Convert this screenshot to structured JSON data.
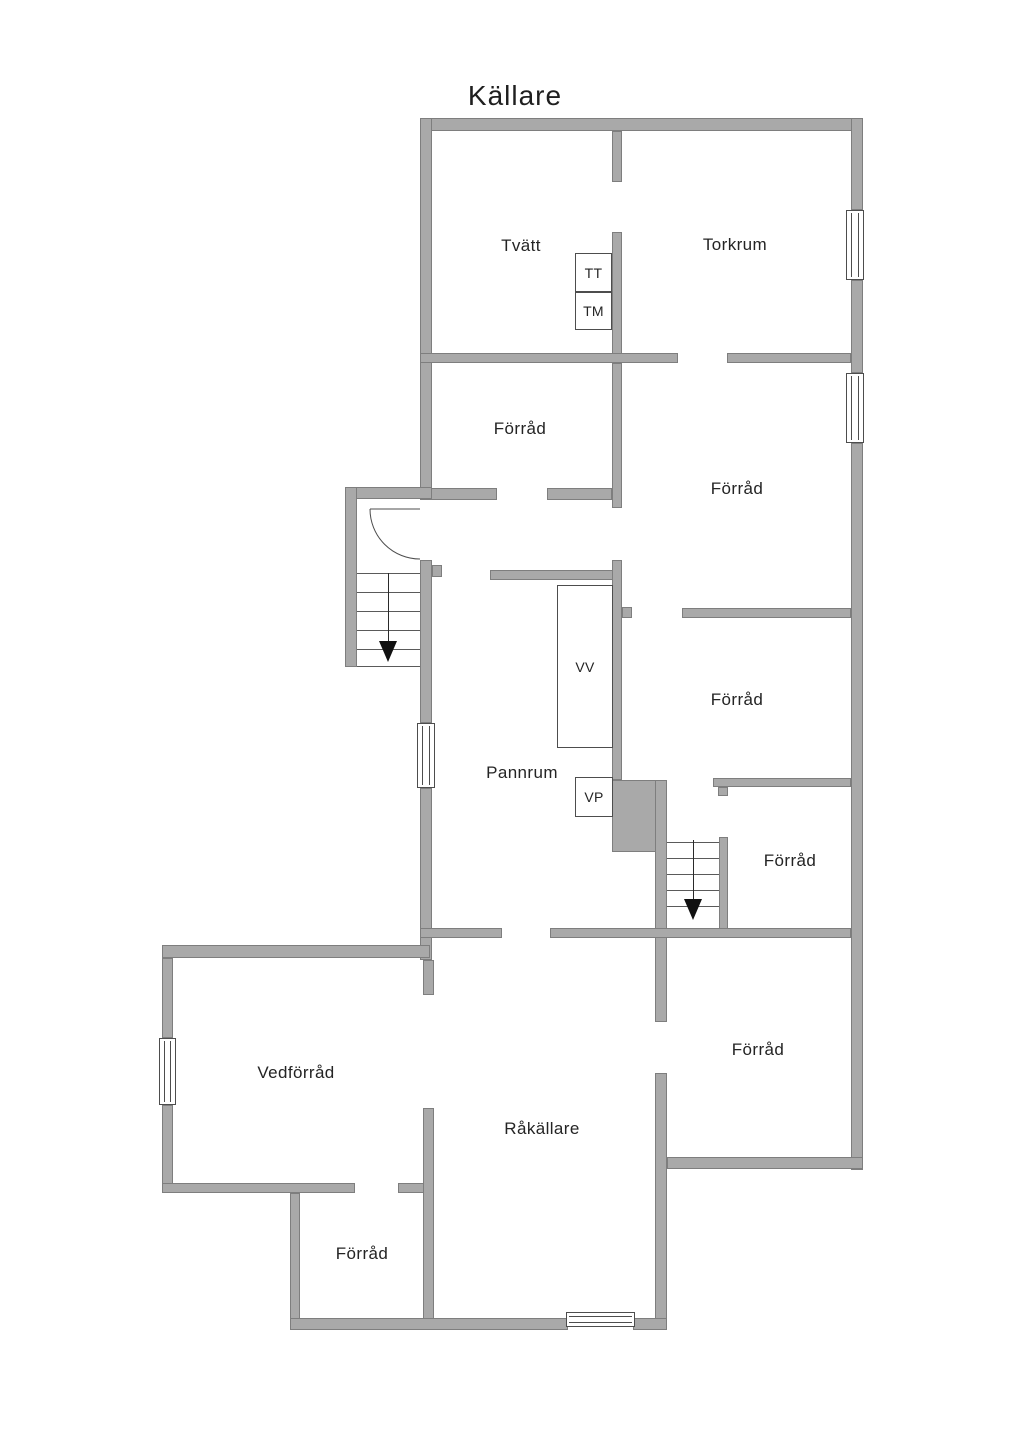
{
  "title": "Källare",
  "colors": {
    "wall_fill": "#a9a9a9",
    "wall_edge": "#7e7e7e",
    "line": "#4d4d4d",
    "text": "#242424",
    "background": "#ffffff"
  },
  "rooms": [
    {
      "label": "Tvätt",
      "cx": 521,
      "cy": 246
    },
    {
      "label": "Torkrum",
      "cx": 735,
      "cy": 245
    },
    {
      "label": "Förråd",
      "cx": 520,
      "cy": 429
    },
    {
      "label": "Förråd",
      "cx": 737,
      "cy": 489
    },
    {
      "label": "Förråd",
      "cx": 737,
      "cy": 700
    },
    {
      "label": "Förråd",
      "cx": 790,
      "cy": 861
    },
    {
      "label": "Pannrum",
      "cx": 522,
      "cy": 773
    },
    {
      "label": "Förråd",
      "cx": 758,
      "cy": 1050
    },
    {
      "label": "Vedförråd",
      "cx": 296,
      "cy": 1073
    },
    {
      "label": "Råkällare",
      "cx": 542,
      "cy": 1129
    },
    {
      "label": "Förråd",
      "cx": 362,
      "cy": 1254
    }
  ],
  "appliances": [
    {
      "label": "TT",
      "x": 575,
      "y": 253,
      "w": 37,
      "h": 39
    },
    {
      "label": "TM",
      "x": 575,
      "y": 292,
      "w": 37,
      "h": 38
    },
    {
      "label": "VV",
      "x": 557,
      "y": 585,
      "w": 56,
      "h": 163
    },
    {
      "label": "VP",
      "x": 575,
      "y": 777,
      "w": 38,
      "h": 40
    }
  ],
  "plan": {
    "walls": [
      {
        "x": 420,
        "y": 118,
        "w": 443,
        "h": 13
      },
      {
        "x": 420,
        "y": 118,
        "w": 12,
        "h": 381
      },
      {
        "x": 420,
        "y": 560,
        "w": 12,
        "h": 163
      },
      {
        "x": 420,
        "y": 788,
        "w": 12,
        "h": 172
      },
      {
        "x": 423,
        "y": 960,
        "w": 11,
        "h": 35
      },
      {
        "x": 423,
        "y": 1108,
        "w": 11,
        "h": 212
      },
      {
        "x": 851,
        "y": 118,
        "w": 12,
        "h": 92
      },
      {
        "x": 851,
        "y": 280,
        "w": 12,
        "h": 93
      },
      {
        "x": 851,
        "y": 443,
        "w": 12,
        "h": 727
      },
      {
        "x": 612,
        "y": 131,
        "w": 10,
        "h": 51
      },
      {
        "x": 612,
        "y": 232,
        "w": 10,
        "h": 131
      },
      {
        "x": 420,
        "y": 353,
        "w": 258,
        "h": 10
      },
      {
        "x": 727,
        "y": 353,
        "w": 124,
        "h": 10
      },
      {
        "x": 612,
        "y": 363,
        "w": 10,
        "h": 145
      },
      {
        "x": 420,
        "y": 488,
        "w": 77,
        "h": 12
      },
      {
        "x": 547,
        "y": 488,
        "w": 65,
        "h": 12
      },
      {
        "x": 345,
        "y": 487,
        "w": 87,
        "h": 12
      },
      {
        "x": 345,
        "y": 487,
        "w": 12,
        "h": 180
      },
      {
        "x": 432,
        "y": 565,
        "w": 10,
        "h": 12
      },
      {
        "x": 490,
        "y": 570,
        "w": 127,
        "h": 10
      },
      {
        "x": 612,
        "y": 560,
        "w": 10,
        "h": 220
      },
      {
        "x": 622,
        "y": 607,
        "w": 10,
        "h": 11
      },
      {
        "x": 682,
        "y": 608,
        "w": 169,
        "h": 10
      },
      {
        "x": 713,
        "y": 778,
        "w": 138,
        "h": 9
      },
      {
        "x": 718,
        "y": 787,
        "w": 10,
        "h": 9
      },
      {
        "x": 612,
        "y": 780,
        "w": 51,
        "h": 72
      },
      {
        "x": 655,
        "y": 780,
        "w": 12,
        "h": 242
      },
      {
        "x": 655,
        "y": 1073,
        "w": 12,
        "h": 257
      },
      {
        "x": 719,
        "y": 837,
        "w": 9,
        "h": 95
      },
      {
        "x": 420,
        "y": 928,
        "w": 82,
        "h": 10
      },
      {
        "x": 550,
        "y": 928,
        "w": 301,
        "h": 10
      },
      {
        "x": 162,
        "y": 945,
        "w": 268,
        "h": 13
      },
      {
        "x": 162,
        "y": 958,
        "w": 11,
        "h": 80
      },
      {
        "x": 162,
        "y": 1105,
        "w": 11,
        "h": 88
      },
      {
        "x": 162,
        "y": 1183,
        "w": 193,
        "h": 10
      },
      {
        "x": 398,
        "y": 1183,
        "w": 26,
        "h": 10
      },
      {
        "x": 290,
        "y": 1193,
        "w": 10,
        "h": 135
      },
      {
        "x": 290,
        "y": 1318,
        "w": 278,
        "h": 12
      },
      {
        "x": 633,
        "y": 1318,
        "w": 34,
        "h": 12
      },
      {
        "x": 667,
        "y": 1157,
        "w": 196,
        "h": 12
      }
    ],
    "windows": [
      {
        "x": 846,
        "y": 210,
        "w": 18,
        "h": 70,
        "o": "v"
      },
      {
        "x": 846,
        "y": 373,
        "w": 18,
        "h": 70,
        "o": "v"
      },
      {
        "x": 417,
        "y": 723,
        "w": 18,
        "h": 65,
        "o": "v"
      },
      {
        "x": 159,
        "y": 1038,
        "w": 17,
        "h": 67,
        "o": "v"
      },
      {
        "x": 566,
        "y": 1312,
        "w": 69,
        "h": 15,
        "o": "h"
      }
    ],
    "stairs": [
      {
        "x": 357,
        "y": 570,
        "w": 63,
        "tread_ys": [
          573,
          592,
          611,
          630,
          649,
          666
        ],
        "center_x": 388,
        "line_y1": 573,
        "line_y2": 641,
        "arrow_tip_y": 662
      },
      {
        "x": 667,
        "y": 837,
        "w": 52,
        "tread_ys": [
          842,
          858,
          874,
          890,
          906
        ],
        "center_x": 693,
        "line_y1": 840,
        "line_y2": 899,
        "arrow_tip_y": 920
      }
    ],
    "door": {
      "hinge_x": 420,
      "hinge_y": 509,
      "radius": 50,
      "open_x": 370,
      "open_y": 509,
      "arc_end_x": 420,
      "arc_end_y": 559
    }
  }
}
